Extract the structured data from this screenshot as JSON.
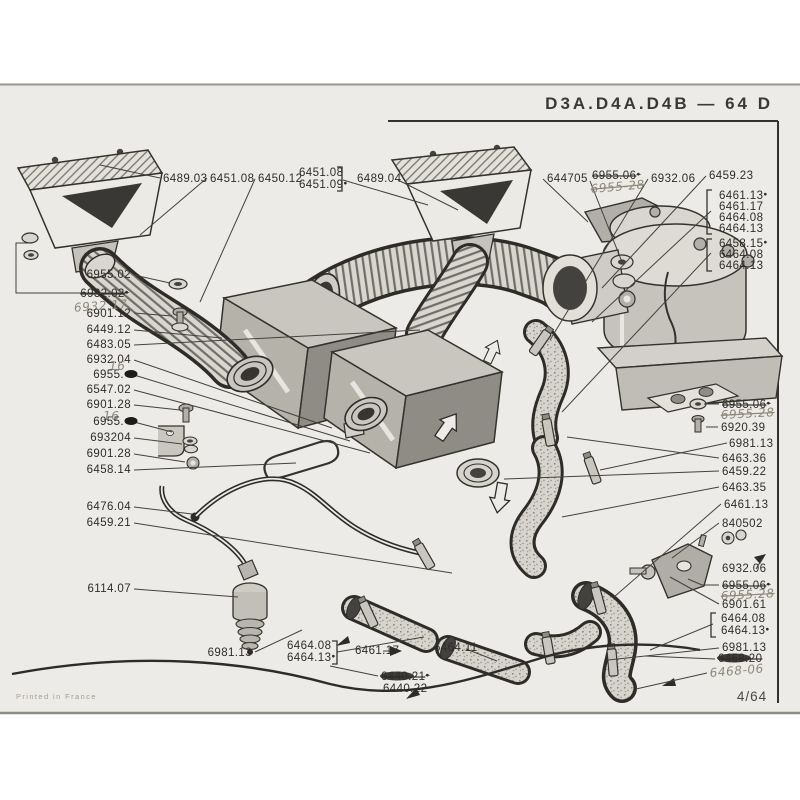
{
  "meta": {
    "title": "D3A.D4A.D4B — 64 D",
    "page_number": "4/64",
    "printed_note": "Printed in France"
  },
  "colors": {
    "page_bg": "#edebe7",
    "ink": "#2e2c29",
    "handwriting": "#8e887b",
    "shade_light": "#d9d6cf",
    "shade_mid": "#b5b2aa",
    "shade_dark": "#44423e"
  },
  "labels": [
    {
      "text": "6489.03",
      "x": 163,
      "y": 182
    },
    {
      "text": "6451.08",
      "x": 210,
      "y": 182
    },
    {
      "text": "6450.12",
      "x": 258,
      "y": 182
    },
    {
      "text": "6451.08",
      "x": 299,
      "y": 176
    },
    {
      "text": "6451.09",
      "x": 299,
      "y": 188,
      "dot": true
    },
    {
      "text": "6489.04",
      "x": 357,
      "y": 182
    },
    {
      "text": "644705",
      "x": 547,
      "y": 182
    },
    {
      "text": "6955.06",
      "x": 592,
      "y": 179,
      "style": "print-struck",
      "dot": true
    },
    {
      "text": "6955-28",
      "x": 591,
      "y": 193,
      "style": "hand-struck",
      "rot": -5
    },
    {
      "text": "6932.06",
      "x": 651,
      "y": 182
    },
    {
      "text": "6459.23",
      "x": 709,
      "y": 179
    },
    {
      "text": "6461.13",
      "x": 719,
      "y": 199,
      "dot": true
    },
    {
      "text": "6461.17",
      "x": 719,
      "y": 210
    },
    {
      "text": "6464.08",
      "x": 719,
      "y": 221
    },
    {
      "text": "6464.13",
      "x": 719,
      "y": 232
    },
    {
      "text": "6458.15",
      "x": 719,
      "y": 247,
      "dot": true
    },
    {
      "text": "6464.08",
      "x": 719,
      "y": 258
    },
    {
      "text": "6464.13",
      "x": 719,
      "y": 269
    },
    {
      "text": "6955.02",
      "x": 131,
      "y": 278,
      "anchor": "end"
    },
    {
      "text": "6932.02",
      "x": 129,
      "y": 297,
      "anchor": "end",
      "style": "print-struck",
      "dot": true
    },
    {
      "text": "6932.17",
      "x": 128,
      "y": 308,
      "anchor": "end",
      "style": "hand",
      "rot": -4
    },
    {
      "text": "6901.12",
      "x": 131,
      "y": 317,
      "anchor": "end"
    },
    {
      "text": "6449.12",
      "x": 131,
      "y": 333,
      "anchor": "end"
    },
    {
      "text": "6483.05",
      "x": 131,
      "y": 348,
      "anchor": "end"
    },
    {
      "text": "6932.04",
      "x": 131,
      "y": 363,
      "anchor": "end"
    },
    {
      "text": "16",
      "x": 109,
      "y": 370,
      "style": "hand",
      "size": 9
    },
    {
      "text": "6955.",
      "x": 124,
      "y": 378,
      "anchor": "end"
    },
    {
      "text": "6547.02",
      "x": 131,
      "y": 393,
      "anchor": "end"
    },
    {
      "text": "6901.28",
      "x": 131,
      "y": 408,
      "anchor": "end"
    },
    {
      "text": "16",
      "x": 103,
      "y": 420,
      "style": "hand",
      "size": 9
    },
    {
      "text": "6955.",
      "x": 124,
      "y": 425,
      "anchor": "end"
    },
    {
      "text": "693204",
      "x": 131,
      "y": 441,
      "anchor": "end"
    },
    {
      "text": "6901.28",
      "x": 131,
      "y": 457,
      "anchor": "end"
    },
    {
      "text": "6458.14",
      "x": 131,
      "y": 473,
      "anchor": "end"
    },
    {
      "text": "6476.04",
      "x": 131,
      "y": 510,
      "anchor": "end"
    },
    {
      "text": "6459.21",
      "x": 131,
      "y": 526,
      "anchor": "end"
    },
    {
      "text": "6114.07",
      "x": 131,
      "y": 592,
      "anchor": "end"
    },
    {
      "text": "6981.13",
      "x": 252,
      "y": 656,
      "anchor": "end"
    },
    {
      "text": "6464.08",
      "x": 287,
      "y": 649
    },
    {
      "text": "6464.13",
      "x": 287,
      "y": 661,
      "dot": true
    },
    {
      "text": "6461.17",
      "x": 355,
      "y": 654
    },
    {
      "text": "6464.11",
      "x": 434,
      "y": 651
    },
    {
      "text": "6440.21",
      "x": 381,
      "y": 680,
      "style": "print-struck",
      "dot": true
    },
    {
      "text": "6440.22",
      "x": 383,
      "y": 692
    },
    {
      "text": "6955.06",
      "x": 722,
      "y": 408,
      "style": "print-struck",
      "dot": true
    },
    {
      "text": "6955.28",
      "x": 721,
      "y": 419,
      "style": "hand-struck",
      "rot": -3
    },
    {
      "text": "6920.39",
      "x": 721,
      "y": 431
    },
    {
      "text": "6981.13",
      "x": 729,
      "y": 447
    },
    {
      "text": "6463.36",
      "x": 722,
      "y": 462
    },
    {
      "text": "6459.22",
      "x": 722,
      "y": 475
    },
    {
      "text": "6463.35",
      "x": 722,
      "y": 491
    },
    {
      "text": "6461.13",
      "x": 724,
      "y": 508
    },
    {
      "text": "840502",
      "x": 722,
      "y": 527
    },
    {
      "text": "6932.06",
      "x": 722,
      "y": 572
    },
    {
      "text": "6955.06",
      "x": 722,
      "y": 589,
      "style": "print-struck",
      "dot": true
    },
    {
      "text": "6955.28",
      "x": 721,
      "y": 600,
      "style": "hand-struck",
      "rot": -3
    },
    {
      "text": "6901.61",
      "x": 722,
      "y": 608
    },
    {
      "text": "6464.08",
      "x": 721,
      "y": 622
    },
    {
      "text": "6464.13",
      "x": 721,
      "y": 634,
      "dot": true
    },
    {
      "text": "6981.13",
      "x": 722,
      "y": 651
    },
    {
      "text": "6468.20",
      "x": 718,
      "y": 662,
      "style": "print-struck"
    },
    {
      "text": "6468-06",
      "x": 710,
      "y": 677,
      "style": "hand",
      "size": 14,
      "rot": -5
    }
  ]
}
